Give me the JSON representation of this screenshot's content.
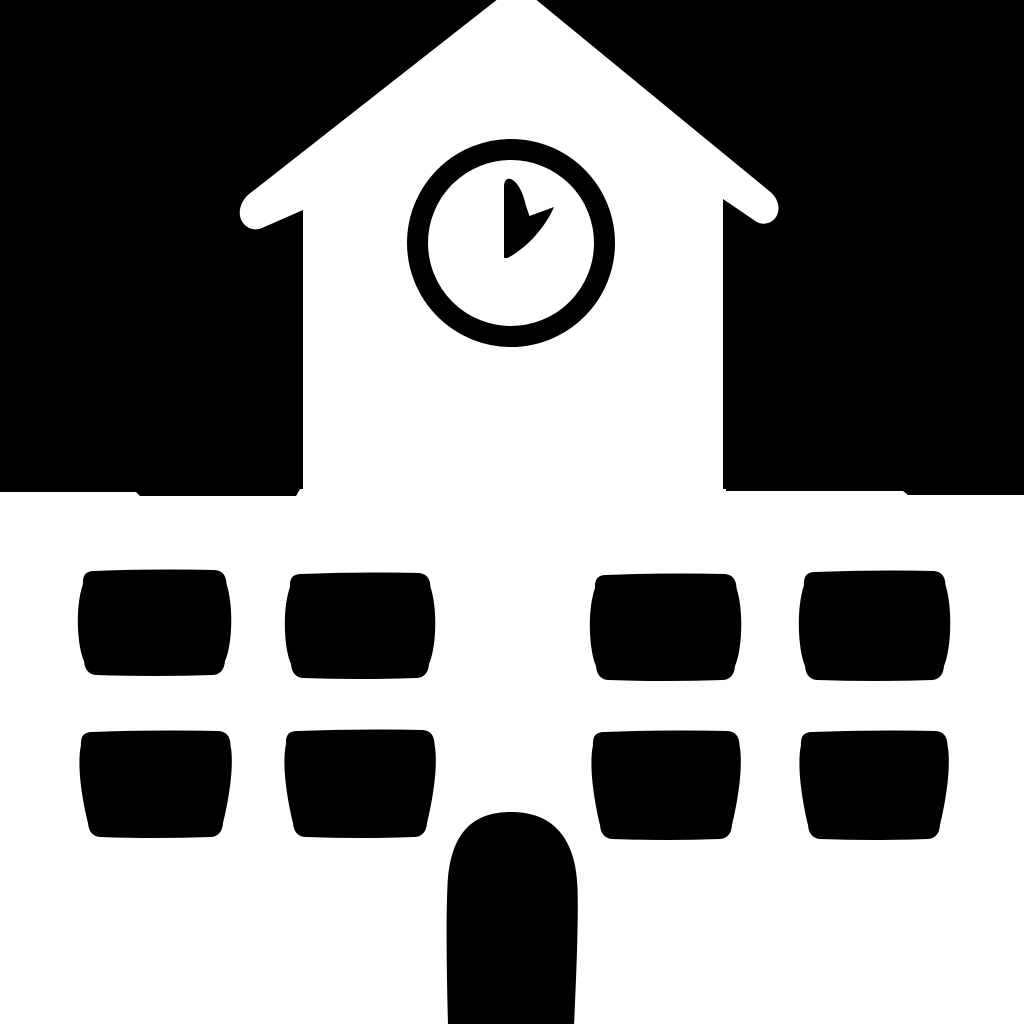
{
  "meta": {
    "type": "icon-glyph",
    "subject": "school building with clock tower",
    "description": "Monochrome schoolhouse icon: white building with triangular roof and clock tower on black upper background; black windows and arched door on white lower background"
  },
  "colors": {
    "background_top": "#000000",
    "background_bottom": "#ffffff",
    "building": "#ffffff",
    "openings": "#000000"
  },
  "canvas": {
    "width": 1024,
    "height": 1024
  },
  "shapes": {
    "sky_path": "M 0 0 H 1024 V 495 H 908 L 903 491 H 726 V 489 H 300 L 296 496 H 140 L 136 492 H 0 Z",
    "house_path": "M 303 500 L 303 210 L 262 228 C 254 231.5 245.5 228 241.5 220.5 C 237.5 212.5 240.5 201.5 248.5 194.5 L 517 -16 L 768 190 C 776.5 196 780.5 205.5 777.5 214 C 774.5 222.5 764 226.5 756 221.5 L 723 199 L 723 500 Z",
    "clock": {
      "cx": 511,
      "cy": 243,
      "radius": 93.5,
      "ring_width": 21,
      "hand_path": "M 504 258 L 504 187 C 504 179 508.5 176.5 514 181 C 520 186 523.5 195 526 206 L 529.5 216 L 554 207 C 547 224 529 247 507.5 258 Z",
      "time_semantic": "hands pointing toward 12 and 2"
    },
    "windows": [
      {
        "x": 82,
        "y": 570,
        "w": 145,
        "h": 105,
        "b": 7,
        "t": 2,
        "row": 1,
        "col": 1
      },
      {
        "x": 289,
        "y": 573,
        "w": 142,
        "h": 105,
        "b": 7,
        "t": 2,
        "row": 1,
        "col": 2
      },
      {
        "x": 594,
        "y": 574,
        "w": 143,
        "h": 106,
        "b": 7,
        "t": 2,
        "row": 1,
        "col": 3
      },
      {
        "x": 803,
        "y": 571,
        "w": 143,
        "h": 109,
        "b": 7,
        "t": 2,
        "row": 1,
        "col": 4
      },
      {
        "x": 80,
        "y": 731,
        "w": 151,
        "h": 106,
        "b": 4,
        "t": 8,
        "row": 2,
        "col": 1
      },
      {
        "x": 285,
        "y": 730,
        "w": 150,
        "h": 107,
        "b": 4,
        "t": 8,
        "row": 2,
        "col": 2
      },
      {
        "x": 592,
        "y": 731,
        "w": 148,
        "h": 108,
        "b": 4,
        "t": 8,
        "row": 2,
        "col": 3
      },
      {
        "x": 800,
        "y": 731,
        "w": 148,
        "h": 108,
        "b": 4,
        "t": 8,
        "row": 2,
        "col": 4
      }
    ],
    "door_path": "M 448 1026 C 446.5 965 446 915 447.5 886 C 450 828 477 811.5 513 812 C 549 812.5 576 834 577.5 888 C 578.5 922 576.5 972 574 1026 Z"
  }
}
